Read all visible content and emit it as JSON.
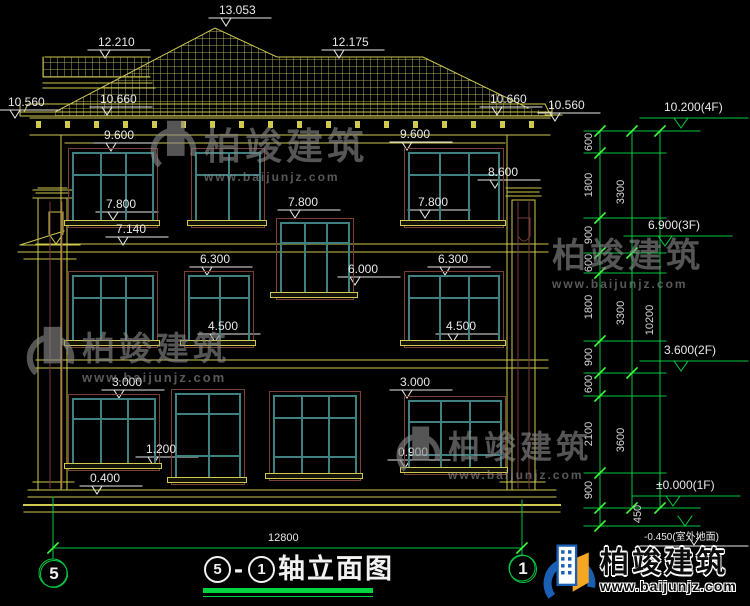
{
  "drawing": {
    "title": {
      "axis_start": "5",
      "dash": "-",
      "axis_end": "1",
      "text": "轴立面图"
    },
    "facade_markers": [
      "13.053",
      "12.210",
      "12.175",
      "10.560",
      "10.660",
      "10.660",
      "10.560",
      "9.600",
      "9.600",
      "8.600",
      "7.800",
      "7.800",
      "7.800",
      "7.140",
      "6.300",
      "6.300",
      "6.000",
      "4.500",
      "4.500",
      "3.000",
      "3.000",
      "1.200",
      "0.900",
      "0.400"
    ],
    "right_levels": [
      "10.200(4F)",
      "6.900(3F)",
      "3.600(2F)",
      "±0.000(1F)",
      "-0.450(室外地面)"
    ],
    "right_dims": {
      "chain": [
        "600",
        "1800",
        "900",
        "600",
        "1800",
        "900",
        "600",
        "2100",
        "900"
      ],
      "cols": [
        "3300",
        "3300",
        "3600"
      ],
      "overall": "10200",
      "below_zero": "450"
    },
    "bottom_dim": "12800",
    "axes": {
      "left": "5",
      "right": "1"
    },
    "watermark": {
      "brand": "柏竣建筑",
      "url": "www.baijunjz.com"
    },
    "logo": {
      "brand": "柏竣建筑",
      "url": "www.baijunjz.com"
    },
    "colors": {
      "line": "#cfc94f",
      "window_frame": "#3f8080",
      "window_trim": "#7a4038",
      "dim_green": "#00c840",
      "tick_green": "#3dff3d",
      "text": "#e8e8e8"
    }
  }
}
